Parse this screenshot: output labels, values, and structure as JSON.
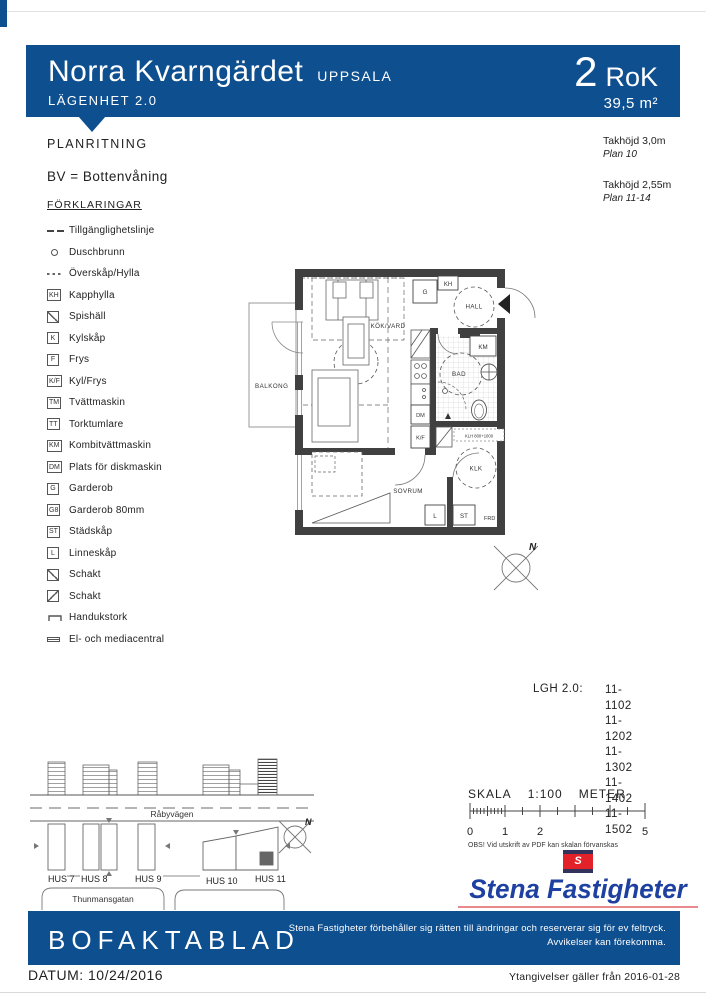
{
  "header": {
    "title": "Norra Kvarngärdet",
    "city": "UPPSALA",
    "apartment": "LÄGENHET 2.0",
    "rok_value": "2",
    "rok_label": "RoK",
    "area": "39,5 m²"
  },
  "info": {
    "plan_heading": "PLANRITNING",
    "bv_note": "BV = Bottenvåning",
    "ceiling1_height": "Takhöjd 3,0m",
    "ceiling1_plan": "Plan 10",
    "ceiling2_height": "Takhöjd 2,55m",
    "ceiling2_plan": "Plan 11-14"
  },
  "legend": {
    "heading": "FÖRKLARINGAR",
    "items": [
      {
        "symbol": "",
        "label": "Tillgänglighetslinje"
      },
      {
        "symbol": "",
        "label": "Duschbrunn"
      },
      {
        "symbol": "",
        "label": "Överskåp/Hylla"
      },
      {
        "symbol": "KH",
        "label": "Kapphylla"
      },
      {
        "symbol": "",
        "label": "Spishäll"
      },
      {
        "symbol": "K",
        "label": "Kylskåp"
      },
      {
        "symbol": "F",
        "label": "Frys"
      },
      {
        "symbol": "K/F",
        "label": "Kyl/Frys"
      },
      {
        "symbol": "TM",
        "label": "Tvättmaskin"
      },
      {
        "symbol": "TT",
        "label": "Torktumlare"
      },
      {
        "symbol": "KM",
        "label": "Kombitvättmaskin"
      },
      {
        "symbol": "DM",
        "label": "Plats för diskmaskin"
      },
      {
        "symbol": "G",
        "label": "Garderob"
      },
      {
        "symbol": "G8",
        "label": "Garderob 80mm"
      },
      {
        "symbol": "ST",
        "label": "Städskåp"
      },
      {
        "symbol": "L",
        "label": "Linneskåp"
      },
      {
        "symbol": "",
        "label": "Schakt"
      },
      {
        "symbol": "",
        "label": "Schakt"
      },
      {
        "symbol": "",
        "label": "Handukstork"
      },
      {
        "symbol": "",
        "label": "El- och mediacentral"
      }
    ]
  },
  "floorplan": {
    "rooms": {
      "kok": "KÖK/VARD",
      "hall": "HALL",
      "bad": "BAD",
      "balkong": "BALKONG",
      "sovrum": "SOVRUM",
      "klk": "KLK",
      "frd": "FRD"
    },
    "boxes": {
      "g": "G",
      "kh": "KH",
      "km": "KM",
      "dm": "DM",
      "kf": "K/F",
      "l": "L",
      "st": "ST"
    },
    "shelf": "KLH 800+1000",
    "north": "N"
  },
  "apartments": {
    "heading": "LGH 2.0:",
    "numbers": [
      "11-1102",
      "11-1202",
      "11-1302",
      "11-1402",
      "11-1502"
    ]
  },
  "siteplan": {
    "road": "Råbyvägen",
    "street": "Thunmansgatan",
    "houses": [
      "HUS 7",
      "HUS 8",
      "HUS 9",
      "HUS 10",
      "HUS 11"
    ],
    "north": "N"
  },
  "scalebar": {
    "skala": "SKALA",
    "ratio": "1:100",
    "unit": "METER",
    "ticks": [
      "0",
      "1",
      "2",
      "5"
    ],
    "warning": "OBS! Vid utskrift av PDF kan skalan förvanskas"
  },
  "logo": {
    "flag_letter": "S",
    "name": "Stena Fastigheter"
  },
  "footer": {
    "title": "BOFAKTABLAD",
    "disclaimer_line1": "Stena Fastigheter förbehåller sig rätten till ändringar och reserverar sig för ev feltryck.",
    "disclaimer_line2": "Avvikelser kan förekomma.",
    "datum_label": "DATUM:",
    "datum_value": "10/24/2016",
    "validity": "Ytangivelser gäller från 2016-01-28"
  },
  "colors": {
    "header_blue": "#0e4f90",
    "logo_blue": "#1e40a0",
    "flag_red": "#e32128",
    "underline_red": "#e88a8d",
    "wall_gray": "#404040"
  }
}
